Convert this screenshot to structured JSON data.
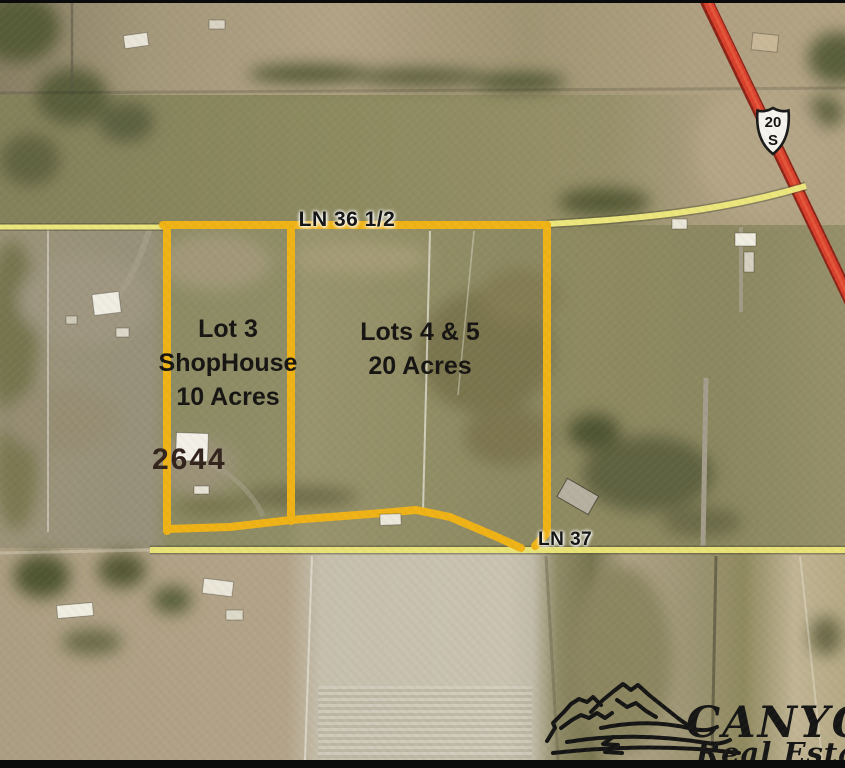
{
  "map": {
    "type": "aerial-parcel-map",
    "road_labels": {
      "ln36": "LN 36 1/2",
      "ln37": "LN 37"
    },
    "highway_shield": {
      "route": "20",
      "direction": "S"
    },
    "parcels": {
      "lot3": {
        "lines": [
          "Lot 3",
          "ShopHouse",
          "10 Acres"
        ]
      },
      "lots45": {
        "lines": [
          "Lots 4 & 5",
          "20 Acres"
        ]
      }
    },
    "address_number": "2644",
    "colors": {
      "parcel_boundary": "#f0b316",
      "road_highlight": "#ece77f",
      "highway_line": "#d63c2a",
      "label_text": "#141414"
    }
  },
  "logo": {
    "name": "CANYON",
    "subtitle": "Real Estate",
    "icon": "mountain-sketch-icon",
    "color": "#151515"
  }
}
